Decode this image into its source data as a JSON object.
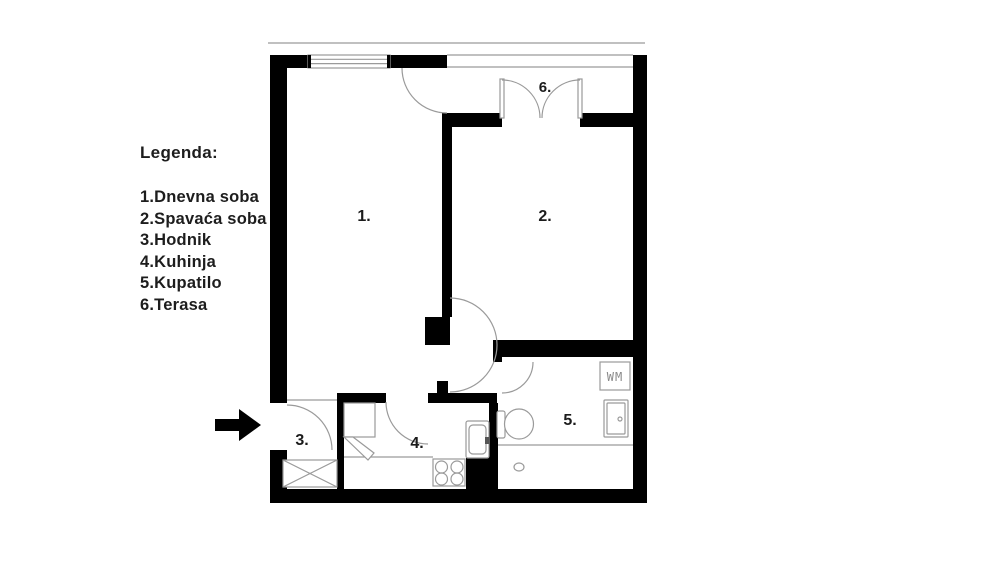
{
  "legend": {
    "title": "Legenda:",
    "items": [
      "1.Dnevna soba",
      "2.Spavaća soba",
      "3.Hodnik",
      "4.Kuhinja",
      "5.Kupatilo",
      "6.Terasa"
    ]
  },
  "floorplan": {
    "rooms": {
      "living_room": "1.",
      "bedroom": "2.",
      "hallway": "3.",
      "kitchen": "4.",
      "bathroom": "5.",
      "terrace": "6."
    },
    "fixtures": {
      "washing_machine_label": "WM"
    }
  },
  "colors": {
    "wall": "#000000",
    "thin_line": "#9a9a9a",
    "text": "#1d1d1d",
    "background": "#ffffff"
  }
}
